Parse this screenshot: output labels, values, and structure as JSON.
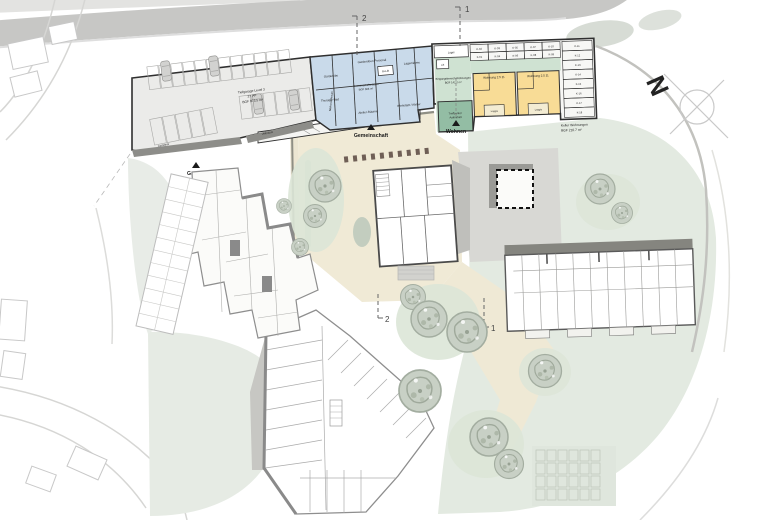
{
  "compass": {
    "north": "N"
  },
  "section_markers": {
    "one": "1",
    "two": "2"
  },
  "entrances": {
    "garage": "Garage",
    "gemeinschaft": "Gemeinschaft",
    "wohnen": "Wohnen"
  },
  "tiefgarage": {
    "line1": "Tiefgarage Level 3",
    "line2": "27 PP",
    "line3": "BGF 973.5 m²",
    "rampe": "Rampe UG",
    "container": "Container",
    "veloraum": "Veloraum"
  },
  "gemeinschaftsraeume": {
    "garderobe": "Garderobe",
    "garderoben_personal": "Garderoben Personal",
    "lagerraeume": "Lagerräume",
    "therapie_bad": "Therapie-Bad",
    "atelier_raeume": "Atelier-Räume",
    "werkstatt_atelier": "Werkstatt / Atelier",
    "mehrzweckraum": "Mehrzweckraum",
    "lift": "B+Lift",
    "area_line1": "Gemeinschaftsräume",
    "area_line2": "BGF 506 m²"
  },
  "eingang": {
    "line1": "Eingangsbereich Wohnungen",
    "line2": "BGF 142.2 m²",
    "lager": "Lager",
    "lift": "Lift",
    "treff_line1": "Treffpunkt /",
    "treff_line2": "Aufenthalt"
  },
  "wohnungen": {
    "label": "Wohnung 2.5 Zi.",
    "loggia": "Loggia"
  },
  "keller": {
    "top_row": [
      "K-02",
      "K-03",
      "K-05",
      "K-07",
      "K-10"
    ],
    "bottom_row": [
      "K-01",
      "K-04",
      "K-06",
      "K-08",
      "K-09"
    ],
    "right_col": [
      "K-11",
      "K-12",
      "K-13",
      "K-14",
      "K-15",
      "K-16",
      "K-17",
      "K-18"
    ],
    "label_line1": "Keller Wohnungen",
    "label_line2": "BGF 210.7 m²"
  },
  "zone_colors": {
    "community_blue": "#c9daea",
    "apartment_yellow": "#f8dc96",
    "entry_green": "#cfe2d2",
    "treffpunkt_green": "#93bda4",
    "courtyard_cream": "#f0ead6",
    "lawn_green": "#e3eae1"
  }
}
